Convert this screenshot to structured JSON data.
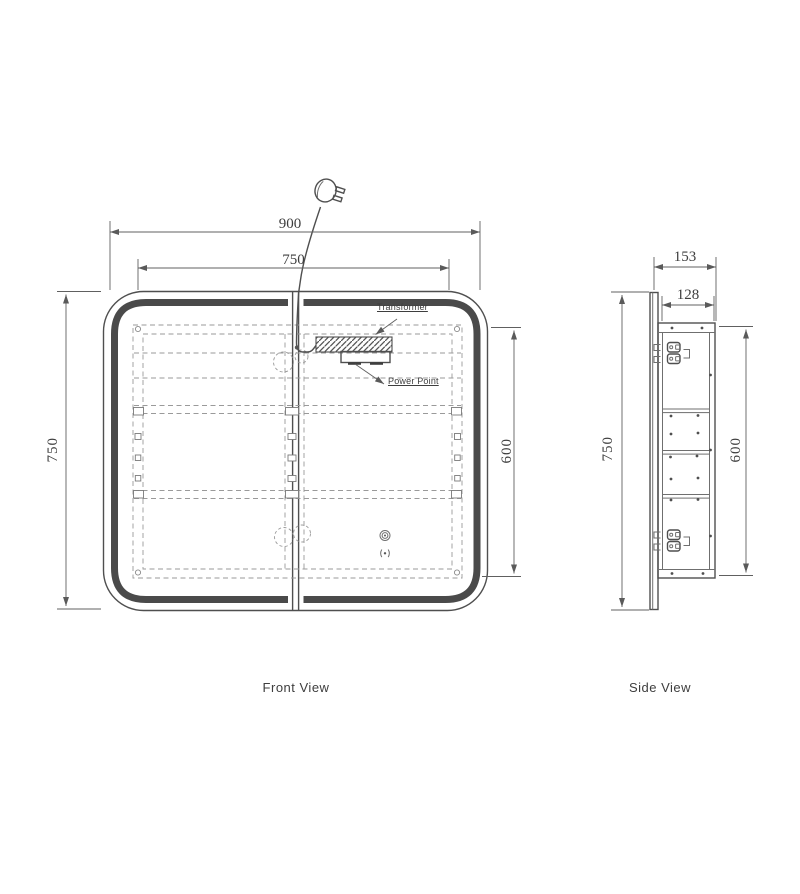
{
  "front_view": {
    "label": "Front View",
    "dim_overall_width_mm": "900",
    "dim_led_width_mm": "750",
    "dim_overall_height_mm": "750",
    "dim_inner_height_mm": "600",
    "transformer_label": "Transformer",
    "power_point_label": "Power Point"
  },
  "side_view": {
    "label": "Side View",
    "dim_overall_depth_mm": "153",
    "dim_cabinet_depth_mm": "128",
    "dim_overall_height_mm": "750",
    "dim_cabinet_height_mm": "600"
  },
  "colors": {
    "background": "#ffffff",
    "line": "#4f4f4f",
    "led_band": "#4a4a4a",
    "dimension": "#606060",
    "dashed": "#9a9a9a",
    "text": "#3e3e3e"
  }
}
